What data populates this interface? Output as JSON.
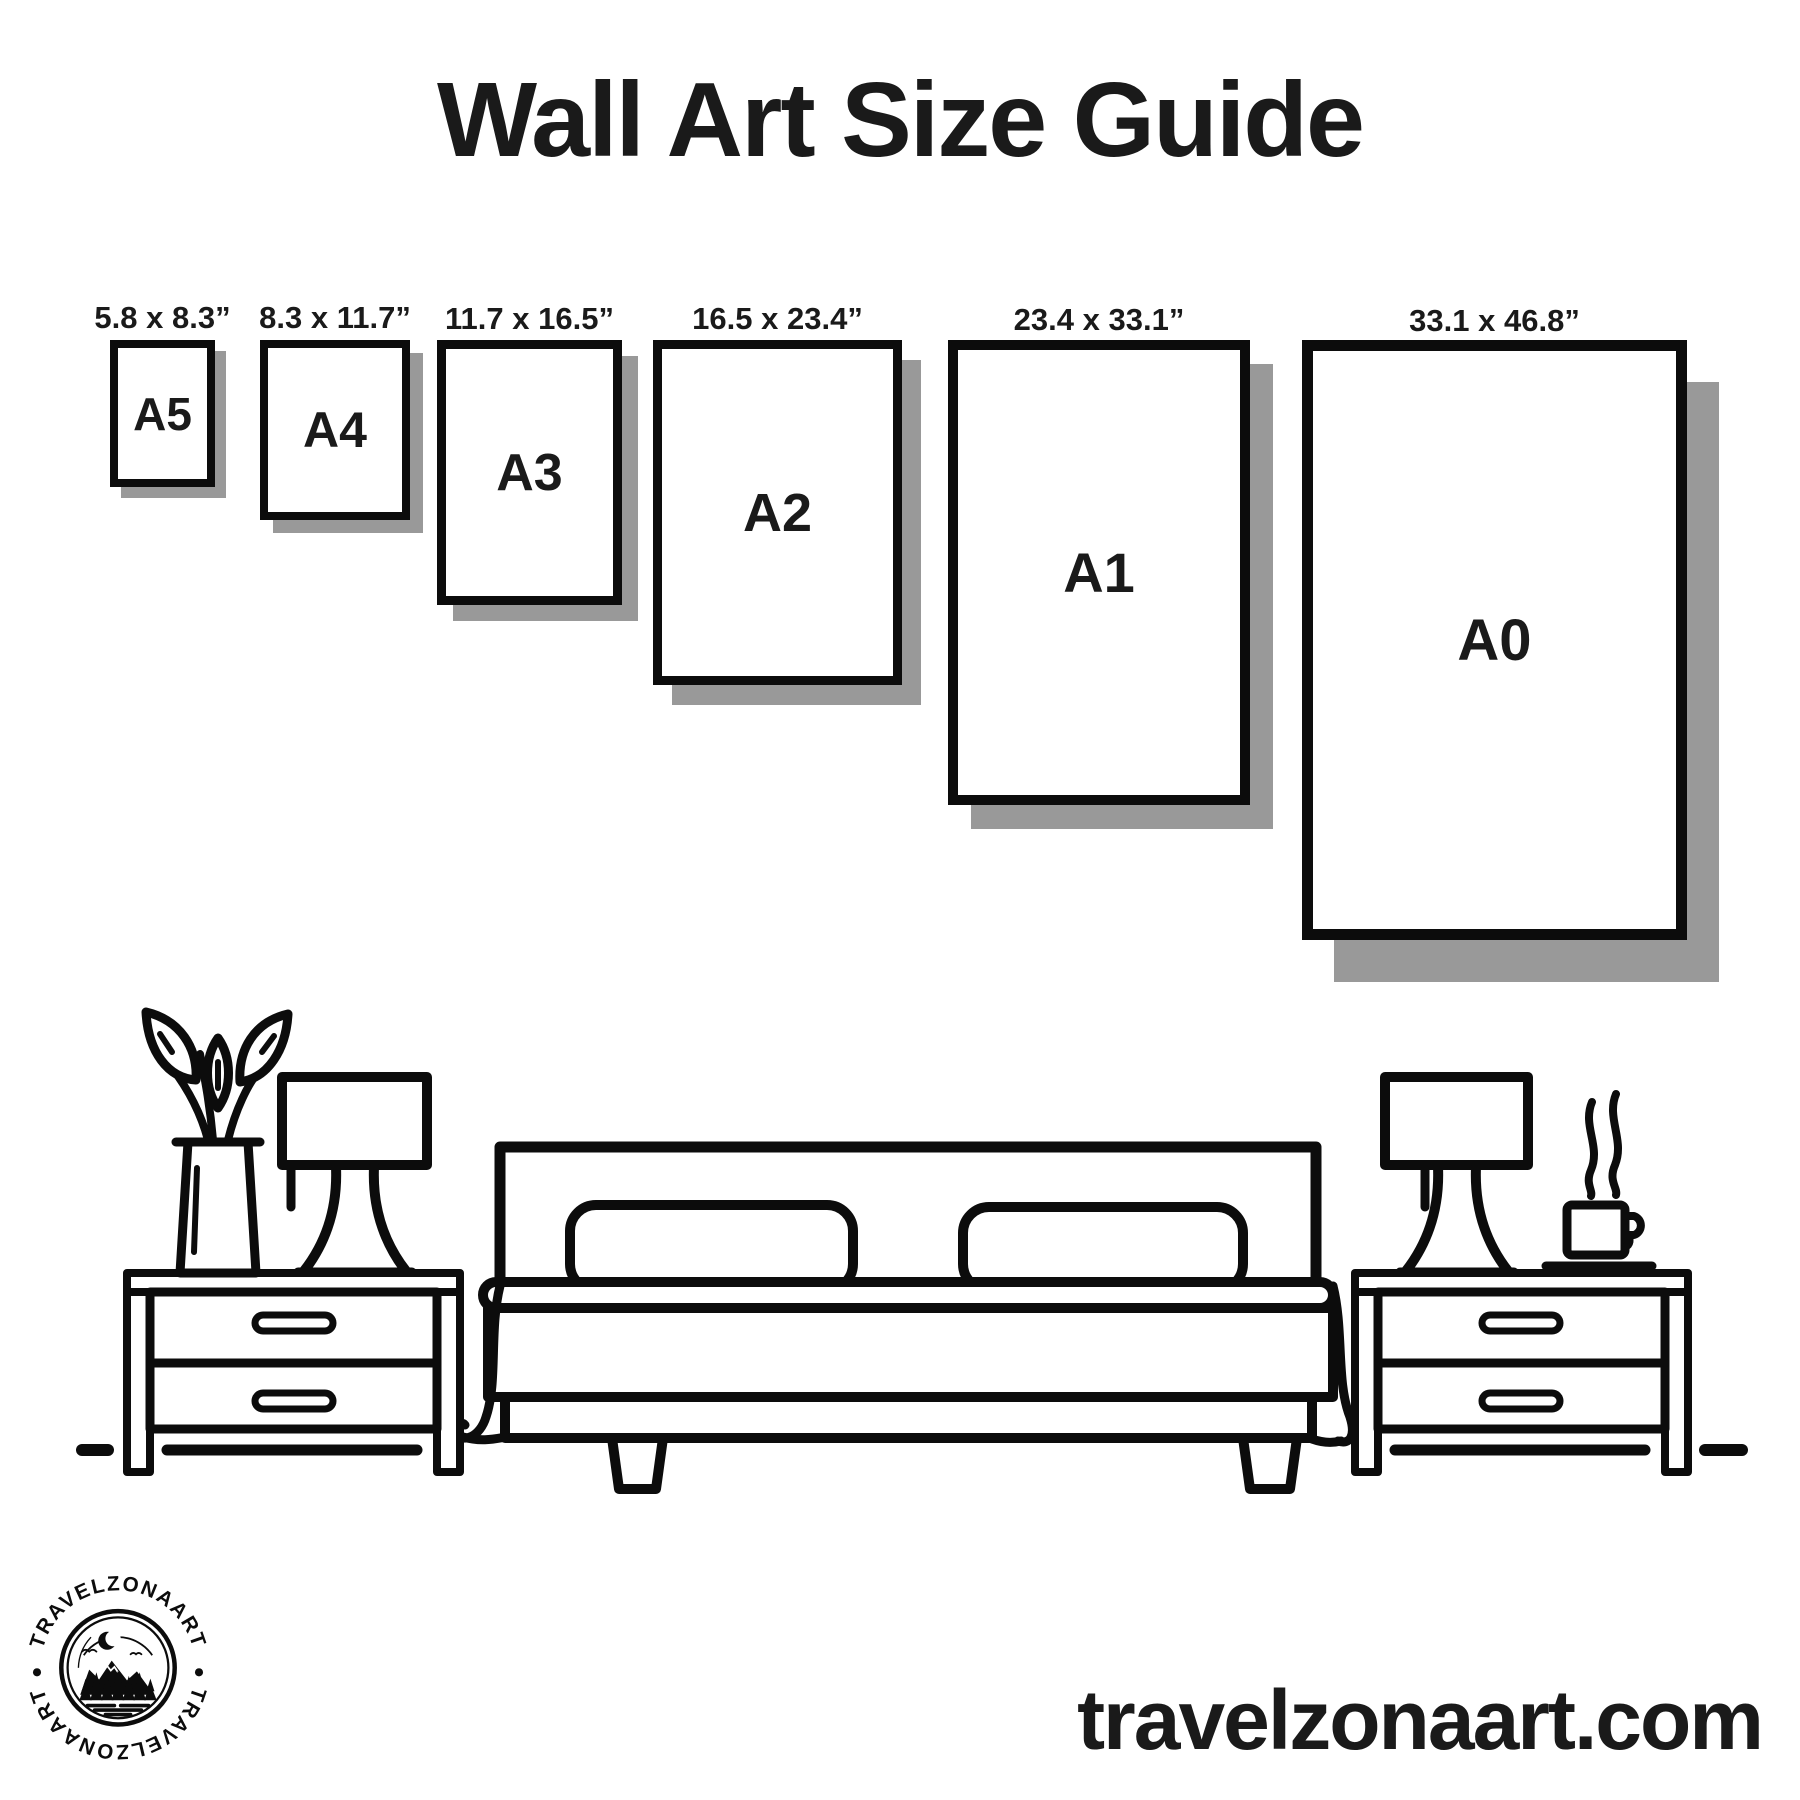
{
  "title": "Wall Art Size Guide",
  "sizes": [
    {
      "name": "A5",
      "dimensions": "5.8 x 8.3”"
    },
    {
      "name": "A4",
      "dimensions": "8.3 x 11.7”"
    },
    {
      "name": "A3",
      "dimensions": "11.7 x 16.5”"
    },
    {
      "name": "A2",
      "dimensions": "16.5 x 23.4”"
    },
    {
      "name": "A1",
      "dimensions": "23.4 x 33.1”"
    },
    {
      "name": "A0",
      "dimensions": "33.1 x 46.8”"
    }
  ],
  "website": "travelzonaart.com",
  "logo": {
    "brand": "TRAVELZONAART"
  },
  "scene": {
    "icons": [
      "plant-icon",
      "table-lamp-icon",
      "nightstand-icon",
      "bed-icon",
      "pillow-icon",
      "coffee-cup-icon",
      "steam-icon",
      "floor-line"
    ]
  },
  "colors": {
    "ink": "#0c0c0c",
    "shadow": "#999999",
    "background": "#ffffff",
    "text": "#1a1a1a"
  }
}
